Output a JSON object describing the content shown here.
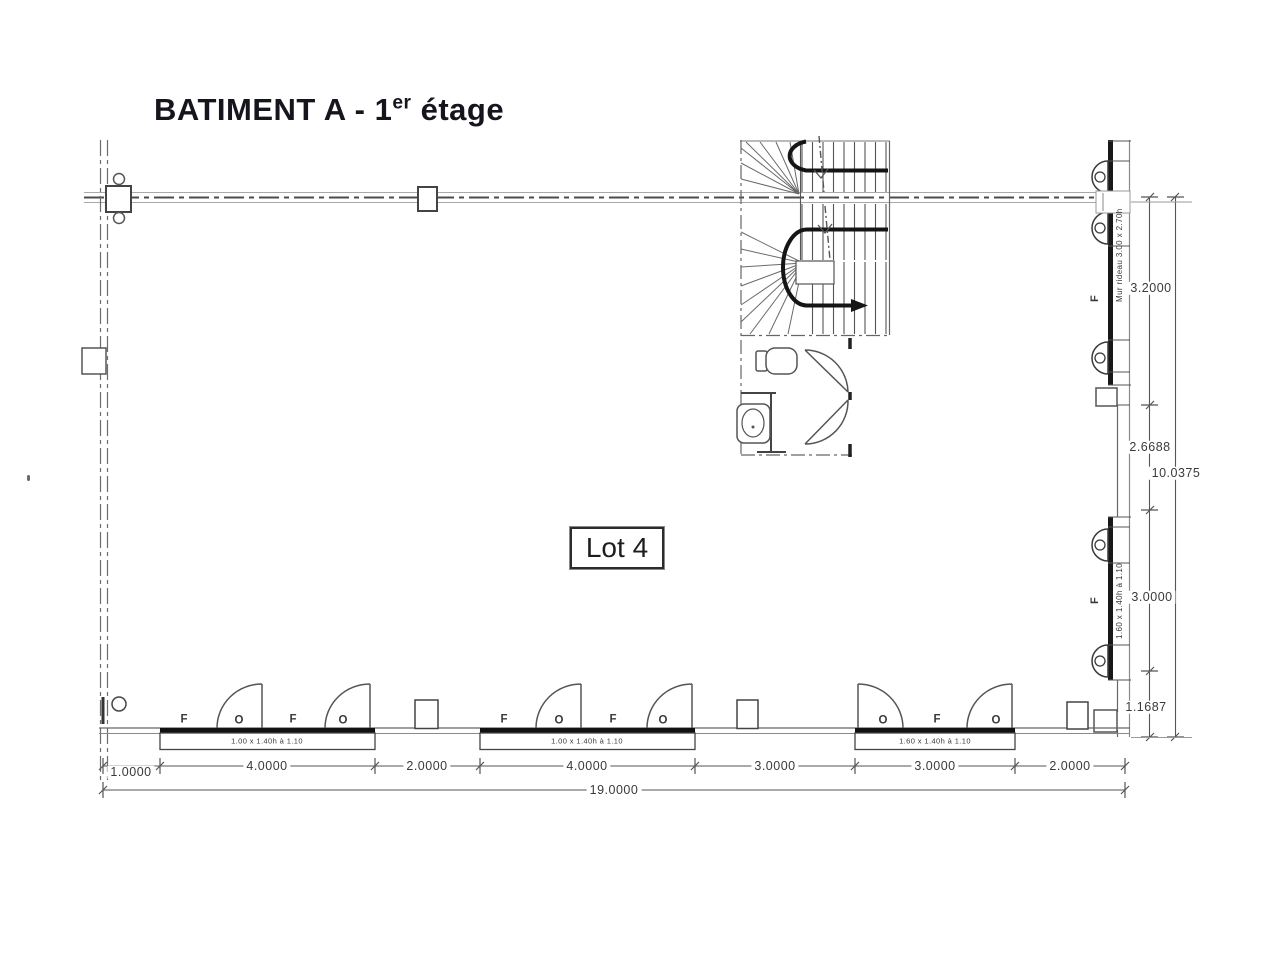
{
  "title": {
    "main": "BATIMENT A - 1",
    "sup": "er",
    "rest": " étage"
  },
  "lot": {
    "label": "Lot 4"
  },
  "dims": {
    "bottom": [
      "1.0000",
      "4.0000",
      "2.0000",
      "4.0000",
      "3.0000",
      "3.0000",
      "2.0000"
    ],
    "bottom_total": "19.0000",
    "right_a": "3.2000",
    "right_b": "2.6688",
    "right_total": "10.0375",
    "right_c": "3.0000",
    "right_d": "1.1687"
  },
  "windows": {
    "mark_fixed": "F",
    "mark_opening": "O",
    "spec_small": "1.00 x 1.40h à 1.10",
    "spec_large": "1.60 x 1.40h à 1.10",
    "spec_curtain": "Mur rideau 3.00 x 2.70h"
  }
}
